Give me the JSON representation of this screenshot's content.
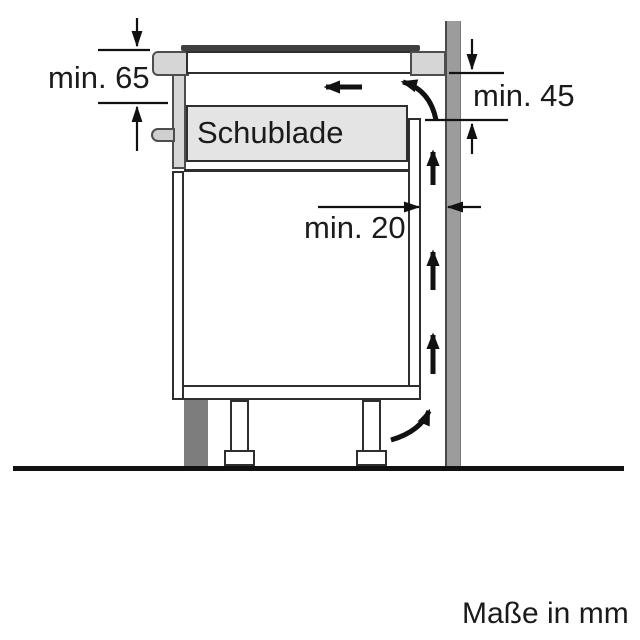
{
  "diagram": {
    "description": "Hob installation clearance cross-section: cabinet with drawer against a wall, airflow path shown",
    "labels": {
      "drawer": "Schublade",
      "top_clearance": "min. 65",
      "rear_clearance": "min. 45",
      "wall_gap": "min. 20"
    },
    "units_note": "Maße in mm",
    "dimensions_mm": {
      "top_clearance_min": 65,
      "rear_clearance_min": 45,
      "wall_gap_min": 20
    },
    "colors": {
      "background": "#ffffff",
      "wall": "#9c9c9c",
      "plinth": "#7d7d7d",
      "worktop": "#d6d6d6",
      "drawer_front": "#e4e4e4",
      "hob_glass": "#3f3f3f",
      "line": "#111111"
    },
    "airflow_arrows": [
      "airflow-left-under-hob",
      "airflow-curve-over-back-panel",
      "airflow-up-rear-gap-1",
      "airflow-up-rear-gap-2",
      "airflow-up-rear-gap-3",
      "airflow-curve-into-gap-bottom"
    ]
  }
}
